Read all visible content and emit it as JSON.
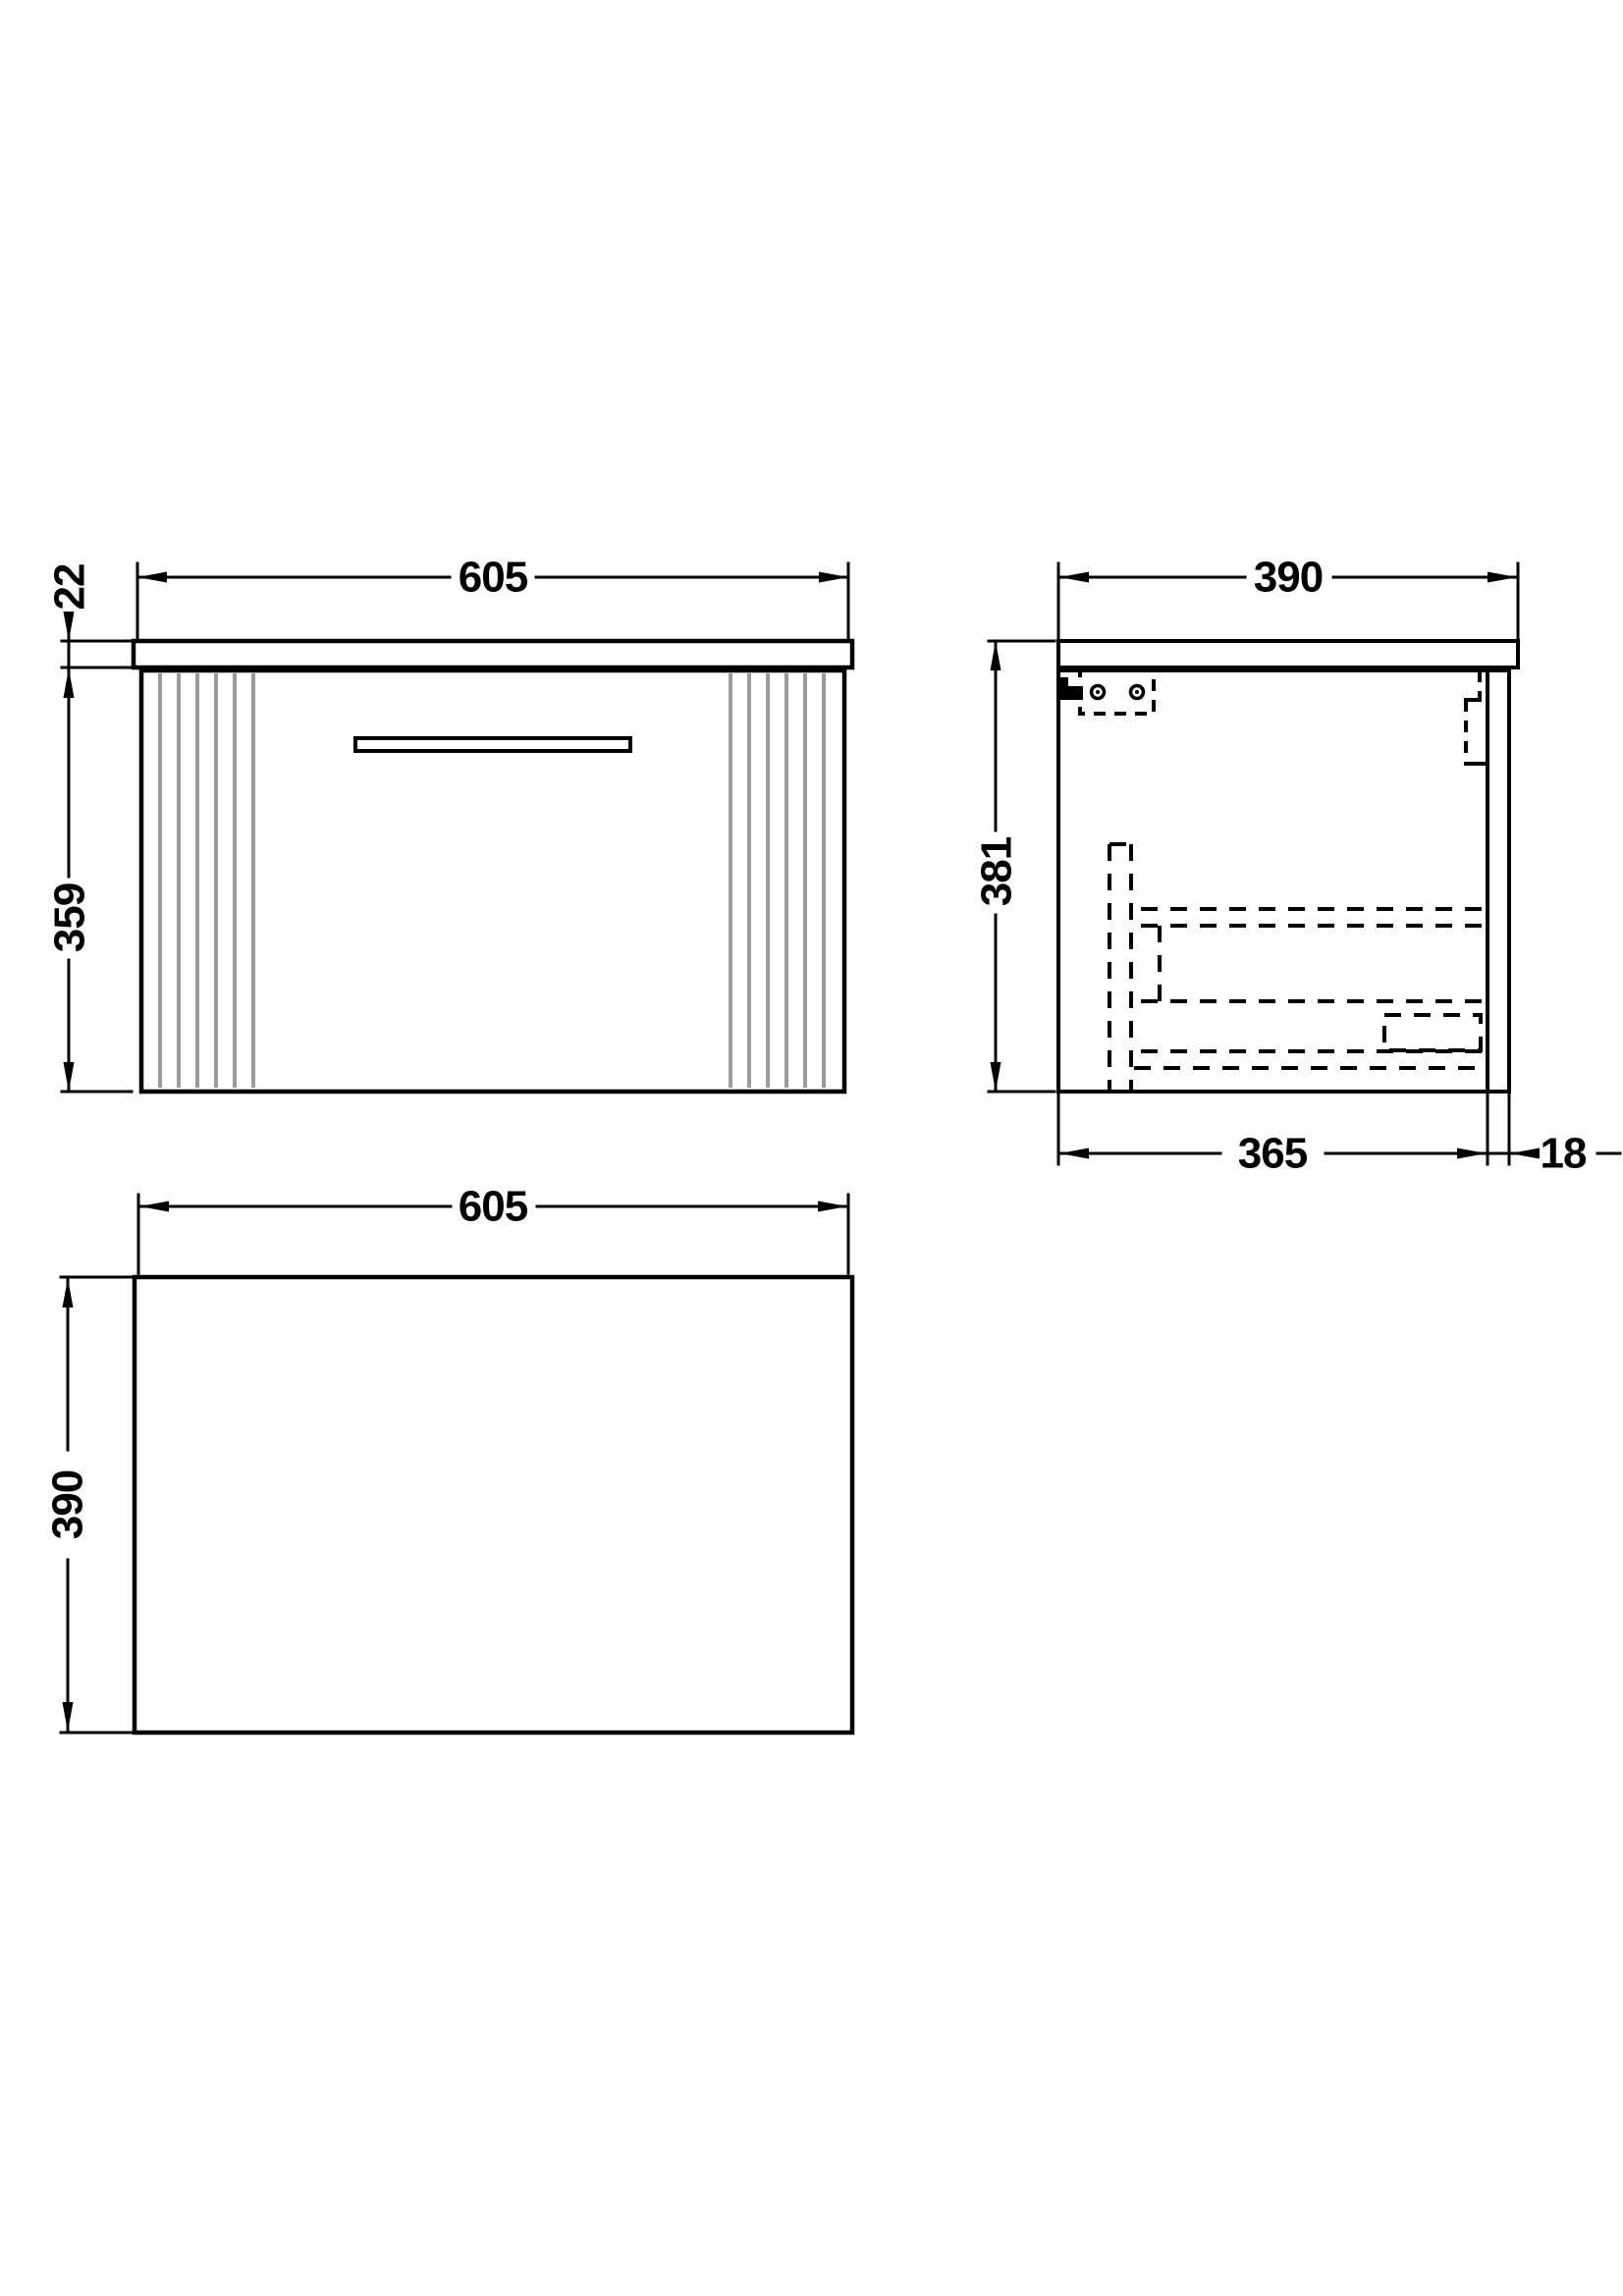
{
  "document": {
    "type": "technical-drawing",
    "subject": "wall-hung vanity cabinet with single drawer, fluted front",
    "units": "mm"
  },
  "colors": {
    "background": "#ffffff",
    "line": "#000000",
    "flute": "#9b9b9b",
    "text": "#000000"
  },
  "views": {
    "front": {
      "title": "front-elevation",
      "width_label": "605",
      "worktop_thickness_label": "22",
      "cabinet_height_label": "359"
    },
    "side": {
      "title": "side-section",
      "overall_depth_label": "390",
      "overall_height_label": "381",
      "internal_depth_label": "365",
      "back_panel_thickness_label": "18"
    },
    "plan": {
      "title": "plan-view",
      "width_label": "605",
      "depth_label": "390"
    }
  }
}
